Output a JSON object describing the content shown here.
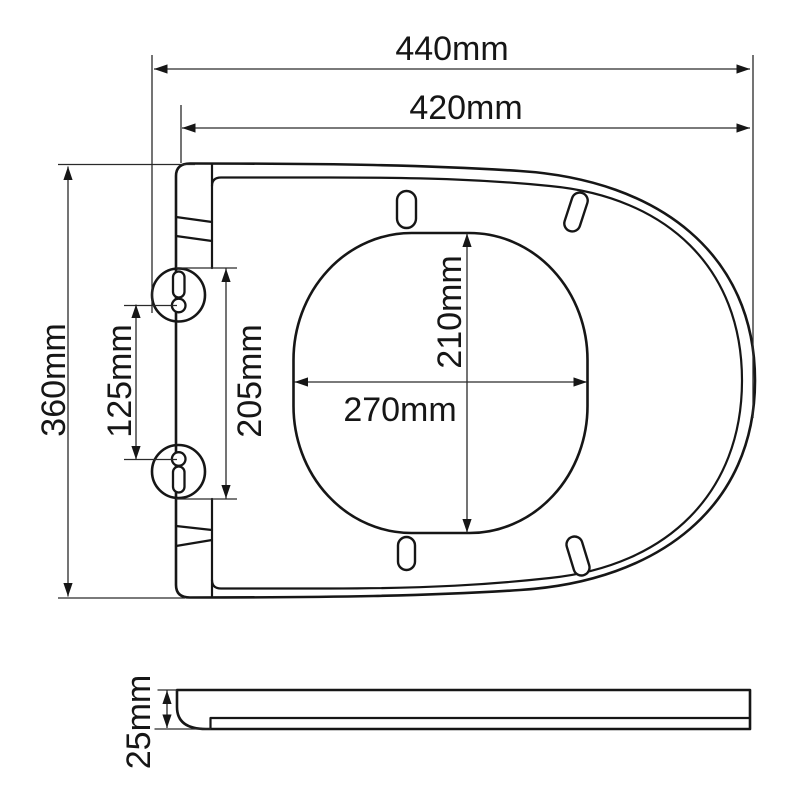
{
  "dimensions": {
    "overall_width_label": "440mm",
    "seat_width_label": "420mm",
    "overall_depth_label": "360mm",
    "hinge_hole_spacing_label": "125mm",
    "hinge_span_label": "205mm",
    "opening_depth_label": "210mm",
    "opening_width_label": "270mm",
    "seat_thickness_label": "25mm"
  },
  "colors": {
    "background": "#ffffff",
    "outline": "#161616",
    "dimension_line": "#2a2a2a"
  }
}
